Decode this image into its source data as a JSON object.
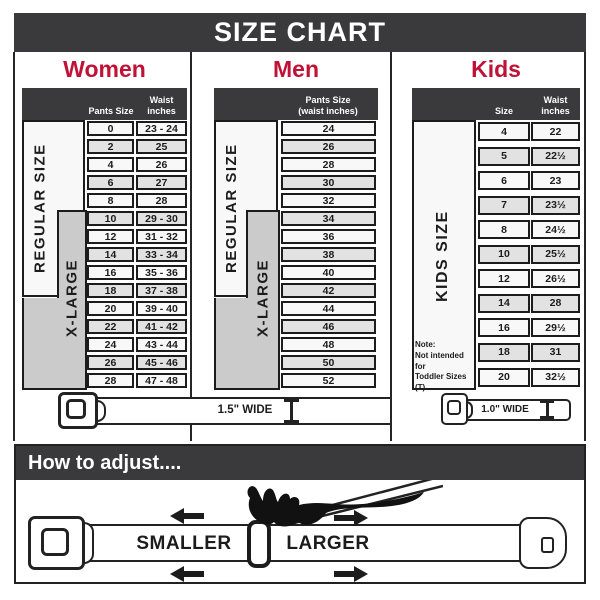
{
  "title": "SIZE CHART",
  "sections": {
    "women": {
      "heading": "Women",
      "header": {
        "col_size": "Pants Size",
        "col_waist_line1": "Waist",
        "col_waist_line2": "inches"
      },
      "labels": {
        "regular": "REGULAR SIZE",
        "xlarge": "X-LARGE"
      },
      "rows": [
        {
          "size": "0",
          "waist": "23 - 24"
        },
        {
          "size": "2",
          "waist": "25"
        },
        {
          "size": "4",
          "waist": "26"
        },
        {
          "size": "6",
          "waist": "27"
        },
        {
          "size": "8",
          "waist": "28"
        },
        {
          "size": "10",
          "waist": "29 - 30"
        },
        {
          "size": "12",
          "waist": "31 - 32"
        },
        {
          "size": "14",
          "waist": "33 - 34"
        },
        {
          "size": "16",
          "waist": "35 - 36"
        },
        {
          "size": "18",
          "waist": "37 - 38"
        },
        {
          "size": "20",
          "waist": "39 - 40"
        },
        {
          "size": "22",
          "waist": "41 - 42"
        },
        {
          "size": "24",
          "waist": "43 - 44"
        },
        {
          "size": "26",
          "waist": "45 - 46"
        },
        {
          "size": "28",
          "waist": "47 - 48"
        }
      ],
      "belt_label": "1.5\" WIDE"
    },
    "men": {
      "heading": "Men",
      "header": {
        "line1": "Pants Size",
        "line2": "(waist inches)"
      },
      "labels": {
        "regular": "REGULAR SIZE",
        "xlarge": "X-LARGE"
      },
      "rows": [
        "24",
        "26",
        "28",
        "30",
        "32",
        "34",
        "36",
        "38",
        "40",
        "42",
        "44",
        "46",
        "48",
        "50",
        "52"
      ]
    },
    "kids": {
      "heading": "Kids",
      "header": {
        "col_size": "Size",
        "col_waist_line1": "Waist",
        "col_waist_line2": "inches"
      },
      "label": "KIDS SIZE",
      "note_lines": [
        "Note:",
        "Not intended for",
        "Toddler Sizes (T)"
      ],
      "rows": [
        {
          "size": "4",
          "waist": "22"
        },
        {
          "size": "5",
          "waist": "22½"
        },
        {
          "size": "6",
          "waist": "23"
        },
        {
          "size": "7",
          "waist": "23½"
        },
        {
          "size": "8",
          "waist": "24½"
        },
        {
          "size": "10",
          "waist": "25½"
        },
        {
          "size": "12",
          "waist": "26½"
        },
        {
          "size": "14",
          "waist": "28"
        },
        {
          "size": "16",
          "waist": "29½"
        },
        {
          "size": "18",
          "waist": "31"
        },
        {
          "size": "20",
          "waist": "32½"
        }
      ],
      "belt_label": "1.0\" WIDE"
    }
  },
  "howto": {
    "title": "How to adjust....",
    "smaller": "SMALLER",
    "larger": "LARGER"
  },
  "colors": {
    "bar": "#3a393b",
    "accent_red": "#c01236",
    "line": "#1c1c1c",
    "cell_light": "#f8f8f8",
    "cell_shaded": "#e3e2e2",
    "label_gray": "#cccbcb"
  }
}
